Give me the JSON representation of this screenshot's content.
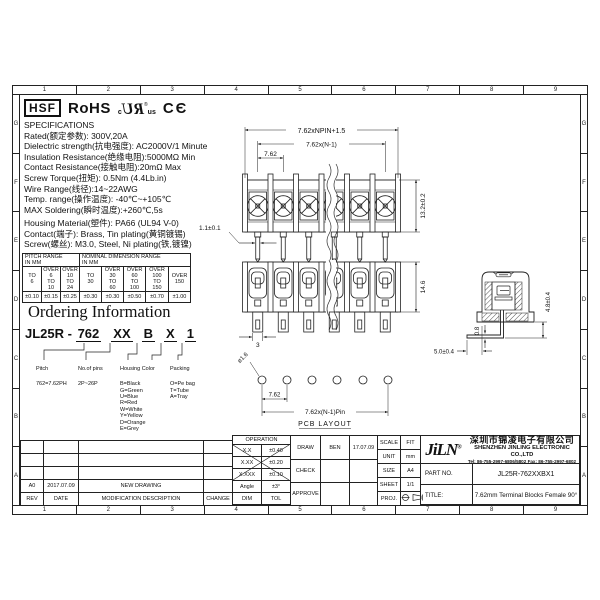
{
  "sheet": {
    "grid_numbers": [
      "1",
      "2",
      "3",
      "4",
      "5",
      "6",
      "7",
      "8",
      "9"
    ],
    "grid_letters": [
      "G",
      "F",
      "E",
      "D",
      "C",
      "B",
      "A"
    ]
  },
  "certifications": {
    "hsf": "HSF",
    "rohs": "RoHS",
    "ul_c": "c",
    "ul_mark": "RU",
    "ul_reg": "®",
    "ul_us": "us",
    "ce": "CЄ"
  },
  "specifications": {
    "title": "SPECIFICATIONS",
    "lines": [
      "Rated(额定参数): 300V,20A",
      "Dielectric strength(抗电强度): AC2000V/1 Minute",
      "Insulation Resistance(绝缘电阻):5000MΩ Min",
      "Contact Resistance(接触电阻):20mΩ Max",
      "Screw Torque(扭矩): 0.5Nm (4.4Lb.in)",
      "Wire Range(线径):14~22AWG",
      "Temp. range(操作温度): -40℃~+105℃",
      "MAX Soldering(瞬时温度):+260℃,5s"
    ],
    "material_lines": [
      "Housing Material(塑件): PA66 (UL94 V-0)",
      "Contact(端子): Brass, Tin plating(黄铜镀锡)",
      "Screw(螺丝): M3.0, Steel, Ni plating(铁,镀镍)"
    ]
  },
  "tolerance_table": {
    "pitch_header": "PITCH RANGE\nIN MM",
    "nominal_header": "NOMINAL DIMENSION RANGE\nIN MM",
    "ranges": [
      "TO\n6",
      "OVER\n6\nTO\n10",
      "OVER\n10\nTO\n24",
      "TO\n30",
      "OVER\n30\nTO\n60",
      "OVER\n60\nTO\n100",
      "OVER\n100\nTO\n150",
      "OVER\n150"
    ],
    "tolerances": [
      "±0.10",
      "±0.15",
      "±0.25",
      "±0.30",
      "±0.30",
      "±0.50",
      "±0.70",
      "±1.00"
    ]
  },
  "ordering": {
    "title": "Ordering Information",
    "code_prefix": "JL25R - ",
    "code_pitch": "762",
    "code_pins": "XX",
    "code_color": "B",
    "code_x": "X",
    "code_pack": "1",
    "callouts": [
      {
        "label": "Pitch",
        "lines": "762=7.62PH"
      },
      {
        "label": "No.of pins",
        "lines": "2P~26P"
      },
      {
        "label": "Housing  Color",
        "lines": "B=Black\nG=Green\nU=Blue\nR=Red\nW=White\nY=Yellow\nD=Orange\nE=Grey"
      },
      {
        "label": "Packing",
        "lines": "O=Pe bag\nT=Tube\nA=Tray"
      }
    ]
  },
  "drawing": {
    "dim_overall": "7.62xNPIN+1.5",
    "dim_span": "7.62x(N-1)",
    "dim_pitch": "7.62",
    "dim_height": "13.2±0.2",
    "dim_pin_width": "1.1±0.1",
    "dim_depth": "14.6",
    "dim_pin_square": "3",
    "dim_pin_thickness": "0.8",
    "dim_tail_height": "4.8±0.4",
    "dim_tail_length": "5.0±0.4",
    "dim_hole": "ø1.6",
    "dim_pcb_pitch": "7.62",
    "dim_pcb_span": "7.62x(N-1)Pin",
    "pcb_label": "PCB LAYOUT"
  },
  "revision": {
    "headers": {
      "rev": "REV",
      "date": "DATE",
      "desc": "MODIFICATION  DESCRIPTION",
      "change": "CHANGE"
    },
    "row": {
      "rev": "A0",
      "date": "2017.07.09",
      "desc": "NEW  DRAWING",
      "change": ""
    }
  },
  "title_block": {
    "operation_label": "OPERATION",
    "tol_rows": [
      {
        "dim": "X.X",
        "tol": "±0.40"
      },
      {
        "dim": "X.XX",
        "tol": "±0.20"
      },
      {
        "dim": "X.XXX",
        "tol": "±0.10"
      },
      {
        "dim": "Angle",
        "tol": "±3°"
      },
      {
        "dim": "DIM",
        "tol": "TOL"
      }
    ],
    "signoff": [
      {
        "role": "DRAW",
        "name": "BEN",
        "date": "17.07.09"
      },
      {
        "role": "CHECK",
        "name": "",
        "date": ""
      },
      {
        "role": "APPROVE",
        "name": "",
        "date": ""
      }
    ],
    "info": [
      {
        "label": "SCALE",
        "value": "FIT"
      },
      {
        "label": "UNIT",
        "value": "mm"
      },
      {
        "label": "SIZE",
        "value": "A4"
      },
      {
        "label": "SHEET",
        "value": "1/1"
      },
      {
        "label": "PROJ.",
        "value": ""
      }
    ],
    "company": {
      "logo": "JiLN",
      "reg": "®",
      "name_cn": "深圳市锦凌电子有限公司",
      "name_en": "SHENZHEN JINLING ELECTRONIC CO.,LTD",
      "contact": "Tel: 86-755-2997-6806/5802    Fax: 86-755-2997-6802",
      "part_no_label": "PART  NO.",
      "part_no": "JL25R-762XXBX1",
      "title_label": "TITLE:",
      "title": "7.62mm Terminal Blocks Female 90°"
    }
  }
}
